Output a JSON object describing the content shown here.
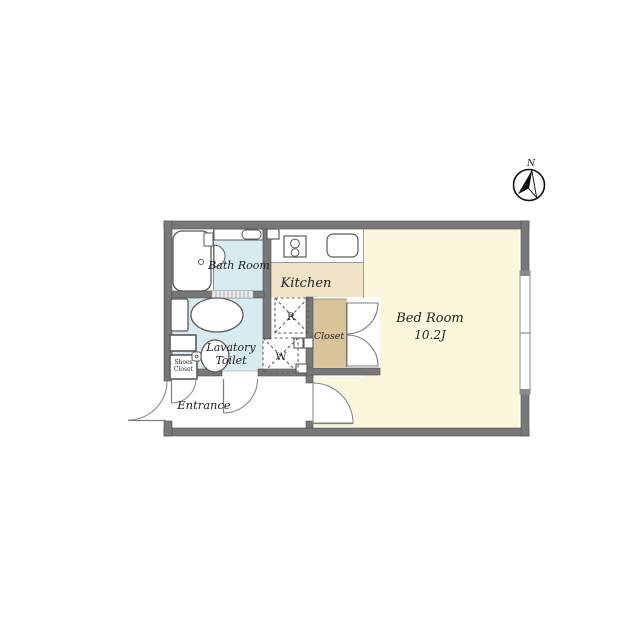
{
  "title": "Apartment floor plan",
  "compass": {
    "north_label": "N"
  },
  "rooms": {
    "bath": {
      "label": "Bath Room"
    },
    "kitchen": {
      "label": "Kitchen"
    },
    "bedroom": {
      "label": "Bed Room",
      "size": "10.2J"
    },
    "lavatory": {
      "label_line1": "Lavatory",
      "label_line2": "Toilet"
    },
    "entrance": {
      "label": "Entrance"
    },
    "closet": {
      "label": "Closet"
    },
    "shoes_closet": {
      "label_line1": "Shoes",
      "label_line2": "Closet"
    },
    "refrigerator_space": {
      "label": "R"
    },
    "washer_space": {
      "label": "W"
    }
  },
  "colors": {
    "wall": "#787878",
    "bath_floor": "#d7ebf1",
    "kitchen_floor": "#f0e2c5",
    "closet_floor": "#d9c499",
    "bedroom_floor": "#fbf7dd",
    "entrance_floor": "#ffffff"
  }
}
